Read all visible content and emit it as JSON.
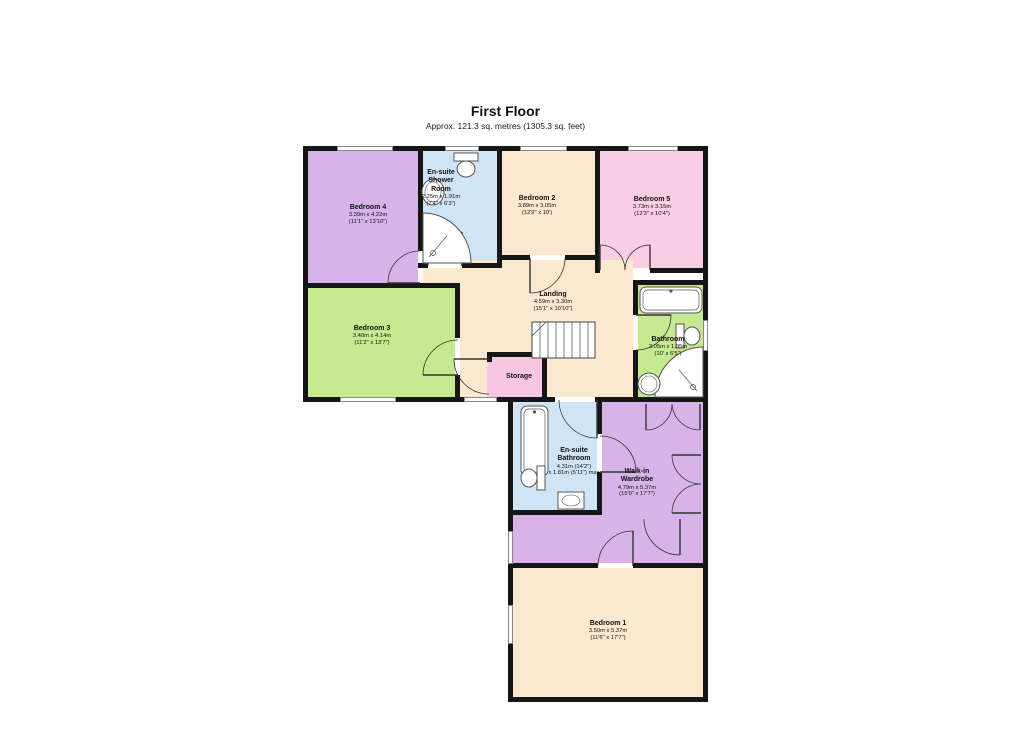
{
  "header": {
    "title": "First Floor",
    "subtitle": "Approx. 121.3 sq. metres (1305.3 sq. feet)"
  },
  "colors": {
    "wall": "#161616",
    "purple": "#d8b3ea",
    "blue": "#cfe5f6",
    "tan": "#fae9ce",
    "pink": "#f9cde2",
    "storage_pink": "#f8c6e0",
    "green": "#c4e98e",
    "fixture_stroke": "#555555",
    "door_stroke": "#333333"
  },
  "floorplan": {
    "rooms": [
      {
        "id": "bedroom-4",
        "name": "Bedroom 4",
        "dims": [
          "3.39m x 4.22m",
          "(11'1\" x 13'10\")"
        ],
        "color": "purple",
        "rects": [
          [
            308,
            151,
            110,
            132
          ]
        ],
        "label": [
          368,
          215
        ]
      },
      {
        "id": "ensuite-shower-room",
        "name": "En-suite\nShower\nRoom",
        "dims": [
          "2.25m x 1.91m",
          "(7'4\" x 6'3\")"
        ],
        "color": "blue",
        "rects": [
          [
            423,
            151,
            74,
            112
          ]
        ],
        "label": [
          441,
          188
        ]
      },
      {
        "id": "bedroom-2",
        "name": "Bedroom 2",
        "dims": [
          "3.89m x 3.05m",
          "(12'9\" x 10')"
        ],
        "color": "tan",
        "rects": [
          [
            502,
            151,
            93,
            104
          ]
        ],
        "label": [
          537,
          206
        ]
      },
      {
        "id": "bedroom-5",
        "name": "Bedroom 5",
        "dims": [
          "3.73m x 3.15m",
          "(12'3\" x 10'4\")"
        ],
        "color": "pink",
        "rects": [
          [
            600,
            151,
            103,
            117
          ]
        ],
        "label": [
          652,
          207
        ]
      },
      {
        "id": "bedroom-3",
        "name": "Bedroom 3",
        "dims": [
          "3.40m x 4.14m",
          "(11'2\" x 13'7\")"
        ],
        "color": "green",
        "rects": [
          [
            308,
            288,
            147,
            109
          ]
        ],
        "label": [
          372,
          336
        ]
      },
      {
        "id": "landing",
        "name": "Landing",
        "dims": [
          "4.59m x 3.30m",
          "(15'1\" x 10'10\")"
        ],
        "color": "tan",
        "rects": [
          [
            460,
            260,
            173,
            137
          ],
          [
            423,
            268,
            37,
            15
          ],
          [
            455,
            268,
            5,
            20
          ],
          [
            600,
            273,
            33,
            12
          ]
        ],
        "label": [
          553,
          302
        ]
      },
      {
        "id": "storage",
        "name": "Storage",
        "dims": [],
        "color": "storage_pink",
        "rects": [
          [
            487,
            357,
            60,
            40
          ]
        ],
        "label": [
          519,
          377
        ]
      },
      {
        "id": "bathroom",
        "name": "Bathroom",
        "dims": [
          "3.05m x 1.95m",
          "(10' x 6'5\")"
        ],
        "color": "green",
        "rects": [
          [
            638,
            285,
            65,
            112
          ]
        ],
        "label": [
          668,
          347
        ]
      },
      {
        "id": "ensuite-bathroom",
        "name": "En-suite\nBathroom",
        "dims": [
          "4.31m (14'2\")",
          "x 1.81m (5'11\") max"
        ],
        "color": "blue",
        "rects": [
          [
            513,
            402,
            84,
            108
          ]
        ],
        "label": [
          574,
          462
        ]
      },
      {
        "id": "walk-in-wardrobe",
        "name": "Walk-in\nWardrobe",
        "dims": [
          "4.79m x 5.37m",
          "(15'9\" x 17'7\")"
        ],
        "color": "purple",
        "rects": [
          [
            602,
            402,
            101,
            161
          ],
          [
            513,
            515,
            89,
            48
          ]
        ],
        "label": [
          637,
          483
        ]
      },
      {
        "id": "bedroom-1",
        "name": "Bedroom 1",
        "dims": [
          "3.50m x 5.37m",
          "(11'6\" x 17'7\")"
        ],
        "color": "tan",
        "rects": [
          [
            513,
            568,
            190,
            129
          ]
        ],
        "label": [
          608,
          631
        ]
      }
    ],
    "walls": [
      [
        303,
        146,
        405,
        5
      ],
      [
        303,
        146,
        5,
        256
      ],
      [
        303,
        397,
        210,
        5
      ],
      [
        508,
        397,
        5,
        305
      ],
      [
        508,
        697,
        200,
        5
      ],
      [
        703,
        146,
        5,
        556
      ],
      [
        418,
        151,
        5,
        100
      ],
      [
        308,
        283,
        152,
        5
      ],
      [
        418,
        263,
        10,
        5
      ],
      [
        462,
        263,
        40,
        5
      ],
      [
        497,
        151,
        5,
        112
      ],
      [
        502,
        255,
        28,
        5
      ],
      [
        565,
        255,
        35,
        5
      ],
      [
        595,
        151,
        5,
        122
      ],
      [
        595,
        268,
        5,
        5
      ],
      [
        650,
        268,
        53,
        5
      ],
      [
        455,
        288,
        5,
        50
      ],
      [
        455,
        375,
        5,
        27
      ],
      [
        633,
        285,
        5,
        30
      ],
      [
        633,
        350,
        5,
        52
      ],
      [
        633,
        280,
        75,
        5
      ],
      [
        487,
        352,
        60,
        5
      ],
      [
        542,
        352,
        5,
        50
      ],
      [
        487,
        352,
        5,
        10
      ],
      [
        597,
        402,
        5,
        32
      ],
      [
        597,
        472,
        5,
        40
      ],
      [
        513,
        510,
        89,
        5
      ],
      [
        513,
        397,
        42,
        5
      ],
      [
        595,
        397,
        7,
        5
      ],
      [
        602,
        397,
        106,
        5
      ],
      [
        513,
        563,
        85,
        5
      ],
      [
        633,
        563,
        75,
        5
      ]
    ],
    "windows": [
      [
        337,
        146,
        56,
        5
      ],
      [
        445,
        146,
        34,
        5
      ],
      [
        520,
        146,
        47,
        5
      ],
      [
        628,
        146,
        50,
        5
      ],
      [
        340,
        397,
        56,
        5
      ],
      [
        464,
        397,
        33,
        5
      ],
      [
        703,
        320,
        5,
        31
      ],
      [
        508,
        531,
        5,
        33
      ],
      [
        508,
        605,
        5,
        39
      ]
    ],
    "doors": [
      {
        "hinge": [
          420,
          283
        ],
        "closed": [
          420,
          251
        ],
        "open": [
          388,
          283
        ],
        "sweep": 0
      },
      {
        "hinge": [
          462,
          266
        ],
        "closed": [
          428,
          266
        ],
        "open": [
          462,
          232
        ],
        "sweep": 1
      },
      {
        "hinge": [
          530,
          258
        ],
        "closed": [
          565,
          258
        ],
        "open": [
          530,
          293
        ],
        "sweep": 1
      },
      {
        "hinge": [
          600,
          270
        ],
        "closed": [
          625,
          270
        ],
        "open": [
          600,
          245
        ],
        "sweep": 0
      },
      {
        "hinge": [
          650,
          270
        ],
        "closed": [
          625,
          270
        ],
        "open": [
          650,
          245
        ],
        "sweep": 1
      },
      {
        "hinge": [
          458,
          375
        ],
        "closed": [
          458,
          340
        ],
        "open": [
          423,
          375
        ],
        "sweep": 0
      },
      {
        "hinge": [
          489,
          359
        ],
        "closed": [
          489,
          394
        ],
        "open": [
          454,
          359
        ],
        "sweep": 1
      },
      {
        "hinge": [
          636,
          315
        ],
        "closed": [
          636,
          350
        ],
        "open": [
          671,
          315
        ],
        "sweep": 0
      },
      {
        "hinge": [
          597,
          400
        ],
        "closed": [
          559,
          400
        ],
        "open": [
          597,
          438
        ],
        "sweep": 0
      },
      {
        "hinge": [
          600,
          472
        ],
        "closed": [
          600,
          436
        ],
        "open": [
          636,
          472
        ],
        "sweep": 1
      },
      {
        "hinge": [
          646,
          404
        ],
        "closed": [
          672,
          404
        ],
        "open": [
          646,
          430
        ],
        "sweep": 1
      },
      {
        "hinge": [
          700,
          404
        ],
        "closed": [
          672,
          404
        ],
        "open": [
          700,
          430
        ],
        "sweep": 0
      },
      {
        "hinge": [
          701,
          455
        ],
        "closed": [
          701,
          484
        ],
        "open": [
          672,
          455
        ],
        "sweep": 1
      },
      {
        "hinge": [
          701,
          513
        ],
        "closed": [
          701,
          484
        ],
        "open": [
          672,
          513
        ],
        "sweep": 0
      },
      {
        "hinge": [
          633,
          566
        ],
        "closed": [
          598,
          566
        ],
        "open": [
          633,
          531
        ],
        "sweep": 1
      },
      {
        "hinge": [
          680,
          519
        ],
        "closed": [
          644,
          519
        ],
        "open": [
          680,
          555
        ],
        "sweep": 0
      }
    ],
    "stairs": {
      "x": 532,
      "y": 322,
      "w": 63,
      "h": 36,
      "tread_step": 8
    },
    "fixtures": [
      {
        "type": "toilet",
        "cx": 466,
        "cy": 165,
        "rot": 0
      },
      {
        "type": "sink",
        "cx": 433,
        "cy": 192,
        "rx": 11,
        "ry": 13
      },
      {
        "type": "shower",
        "x": 423,
        "y": 213,
        "w": 48,
        "h": 50,
        "corner": "bl"
      },
      {
        "type": "bath",
        "x": 640,
        "y": 287,
        "w": 62,
        "h": 26,
        "dir": "h"
      },
      {
        "type": "toilet",
        "cx": 688,
        "cy": 336,
        "rot": 270
      },
      {
        "type": "shower",
        "x": 655,
        "y": 347,
        "w": 48,
        "h": 50,
        "corner": "br"
      },
      {
        "type": "sink",
        "cx": 649,
        "cy": 384,
        "rx": 11,
        "ry": 11
      },
      {
        "type": "bath",
        "x": 521,
        "y": 406,
        "w": 27,
        "h": 70,
        "dir": "v"
      },
      {
        "type": "toilet",
        "cx": 533,
        "cy": 478,
        "rot": 90
      },
      {
        "type": "sinkrect",
        "x": 558,
        "y": 492,
        "w": 26,
        "h": 17
      }
    ]
  }
}
